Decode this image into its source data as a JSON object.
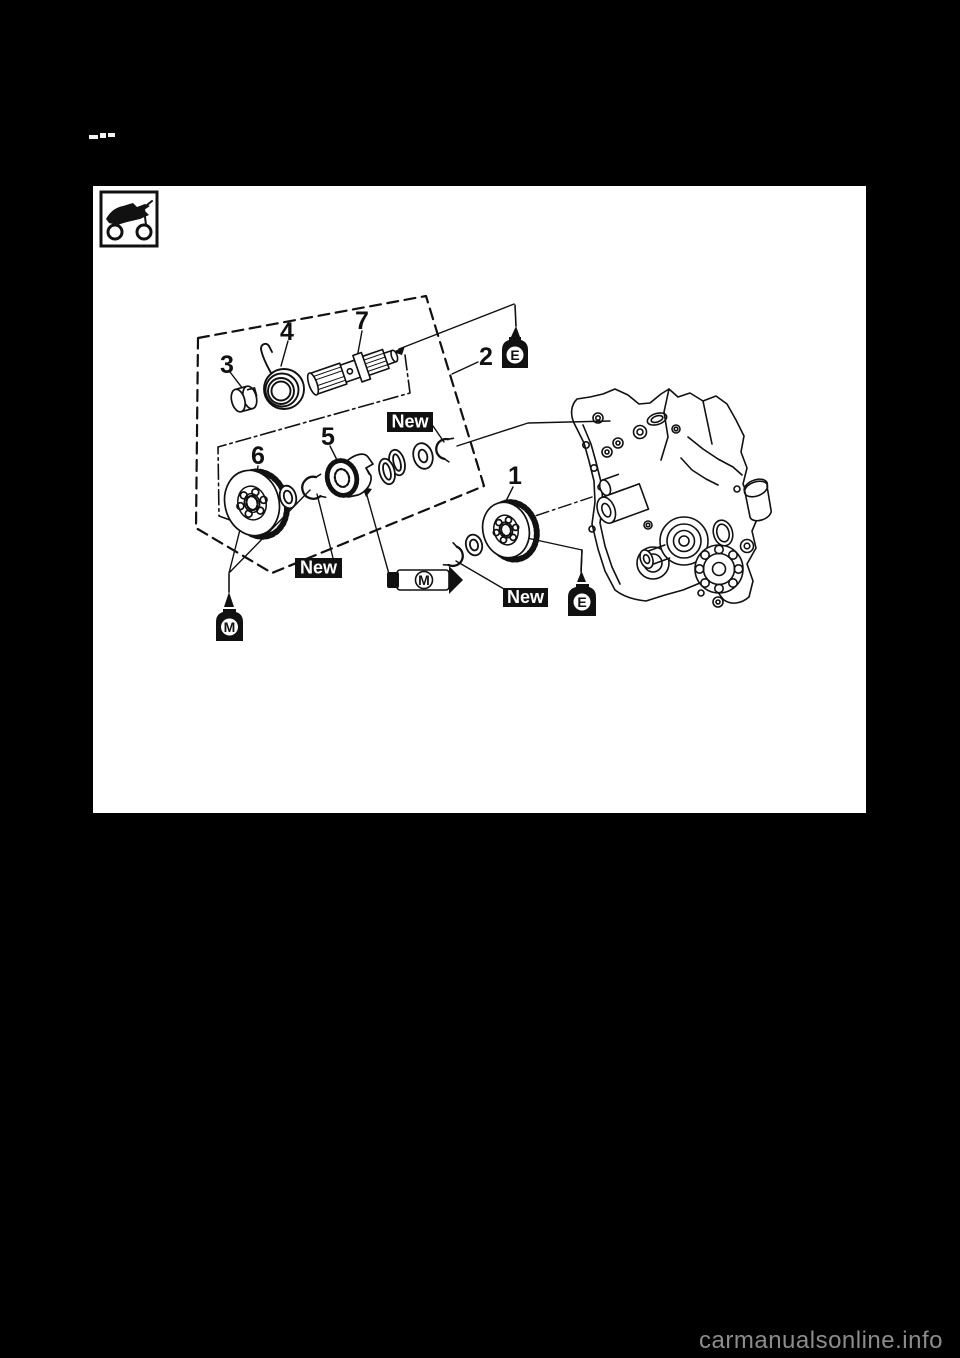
{
  "window": {
    "background": "#000000"
  },
  "page": {
    "background": "#ffffff"
  },
  "diagram": {
    "icon": "off-road-motorcycle",
    "callouts": [
      "1",
      "2",
      "3",
      "4",
      "5",
      "6",
      "7"
    ],
    "badges": [
      "New",
      "New",
      "New"
    ],
    "oil_marks": {
      "engine_oil": "E",
      "molybdenum_grease": "M"
    },
    "line_color": "#111111"
  },
  "watermark": {
    "text": "carmanualsonline.info",
    "color": "#8c8c8c"
  }
}
